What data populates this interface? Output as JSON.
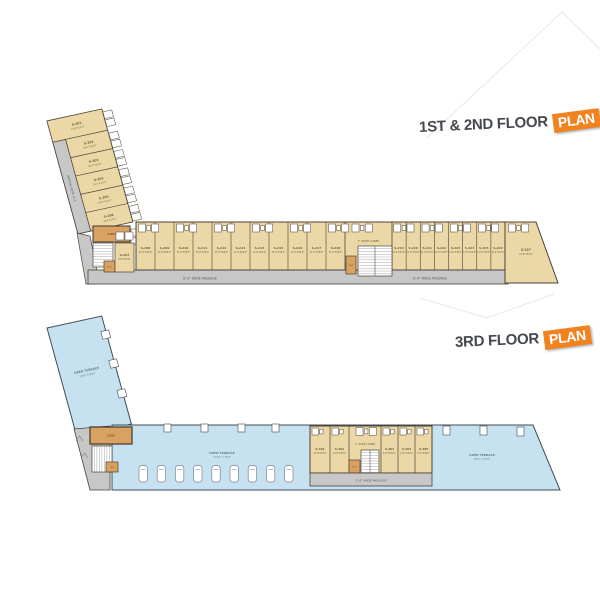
{
  "title1": {
    "label": "1ST & 2ND FLOOR",
    "tag": "PLAN"
  },
  "title2": {
    "label": "3RD FLOOR",
    "tag": "PLAN"
  },
  "plan1": {
    "arm_units": [
      {
        "id": "S-201",
        "dim": "21'6\"X10'0\""
      },
      {
        "id": "S-202",
        "dim": "20'0\"X10'0\""
      },
      {
        "id": "S-203",
        "dim": "20'0\"X10'0\""
      },
      {
        "id": "S-204",
        "dim": "20'0\"X10'0\""
      },
      {
        "id": "S-205",
        "dim": "20'0\"X10'0\""
      },
      {
        "id": "S-206",
        "dim": "20'6\"X10'0\""
      }
    ],
    "corner_unit": {
      "id": "S-207",
      "dim": "8'0\"X16'6\""
    },
    "row_left": [
      {
        "id": "S-208",
        "dim": "11'0\"X30'0\""
      },
      {
        "id": "S-209",
        "dim": "11'0\"X30'0\""
      },
      {
        "id": "S-210",
        "dim": "11'0\"X30'0\""
      },
      {
        "id": "S-211",
        "dim": "11'0\"X30'0\""
      },
      {
        "id": "S-212",
        "dim": "11'0\"X30'0\""
      },
      {
        "id": "S-213",
        "dim": "11'0\"X30'0\""
      },
      {
        "id": "S-214",
        "dim": "11'0\"X30'0\""
      },
      {
        "id": "S-215",
        "dim": "11'0\"X30'0\""
      },
      {
        "id": "S-216",
        "dim": "11'0\"X30'0\""
      },
      {
        "id": "S-217",
        "dim": "11'0\"X30'0\""
      },
      {
        "id": "S-218",
        "dim": "11'0\"X30'0\""
      }
    ],
    "row_right": [
      {
        "id": "S-219",
        "dim": "11'0\"X30'0\""
      },
      {
        "id": "S-220",
        "dim": "11'0\"X30'0\""
      },
      {
        "id": "S-221",
        "dim": "11'0\"X30'0\""
      },
      {
        "id": "S-222",
        "dim": "11'0\"X30'0\""
      },
      {
        "id": "S-223",
        "dim": "11'0\"X30'0\""
      },
      {
        "id": "S-224",
        "dim": "11'0\"X30'0\""
      },
      {
        "id": "S-225",
        "dim": "11'0\"X30'0\""
      },
      {
        "id": "S-226",
        "dim": "11'0\"X30'0\""
      }
    ],
    "end_unit": {
      "id": "S-227",
      "dim": "21'6\"X30'0\""
    },
    "lobby": "7' WIDE LOBBY",
    "lift": "LIFT",
    "corner_lobby": "LOBBY",
    "passage_bottom": "8'-0\" WIDE PASSAGE",
    "passage_left": "5'-0\" WIDE PASSAGE"
  },
  "plan2": {
    "units": [
      {
        "id": "S-301",
        "dim": "11'0\"X30'0\""
      },
      {
        "id": "S-302",
        "dim": "11'0\"X30'0\""
      },
      {
        "id": "S-303",
        "dim": "11'0\"X30'0\""
      },
      {
        "id": "S-304",
        "dim": "11'0\"X30'0\""
      },
      {
        "id": "S-305",
        "dim": "11'0\"X30'0\""
      }
    ],
    "terrace_left": {
      "label": "OPEN TERRACE",
      "dim": "30'0\" X 80'0\""
    },
    "terrace_mid": {
      "label": "OPEN TERRACE",
      "dim": "115'0\" X 35'0\""
    },
    "terrace_right": {
      "label": "OPEN TERRACE",
      "dim": "50'0\" X 35'0\""
    },
    "lobby": "7' WIDE LOBBY",
    "lift": "LIFT",
    "corner_lobby": "LOBBY",
    "passage": "5'-0\" WIDE PASSAGE",
    "car_count": 9
  },
  "colors": {
    "room": "#ecd8a6",
    "wall": "#4a4237",
    "passage": "#c7c7c7",
    "passage_text": "#5a5a5a",
    "lift": "#d9a262",
    "terrace": "#c6e2f1",
    "terrace_wall": "#434b52",
    "label_text": "#6f5f40",
    "terrace_text": "#657a87",
    "accent": "#f0821f",
    "title": "#45484d",
    "watermark": "#ebebeb"
  }
}
